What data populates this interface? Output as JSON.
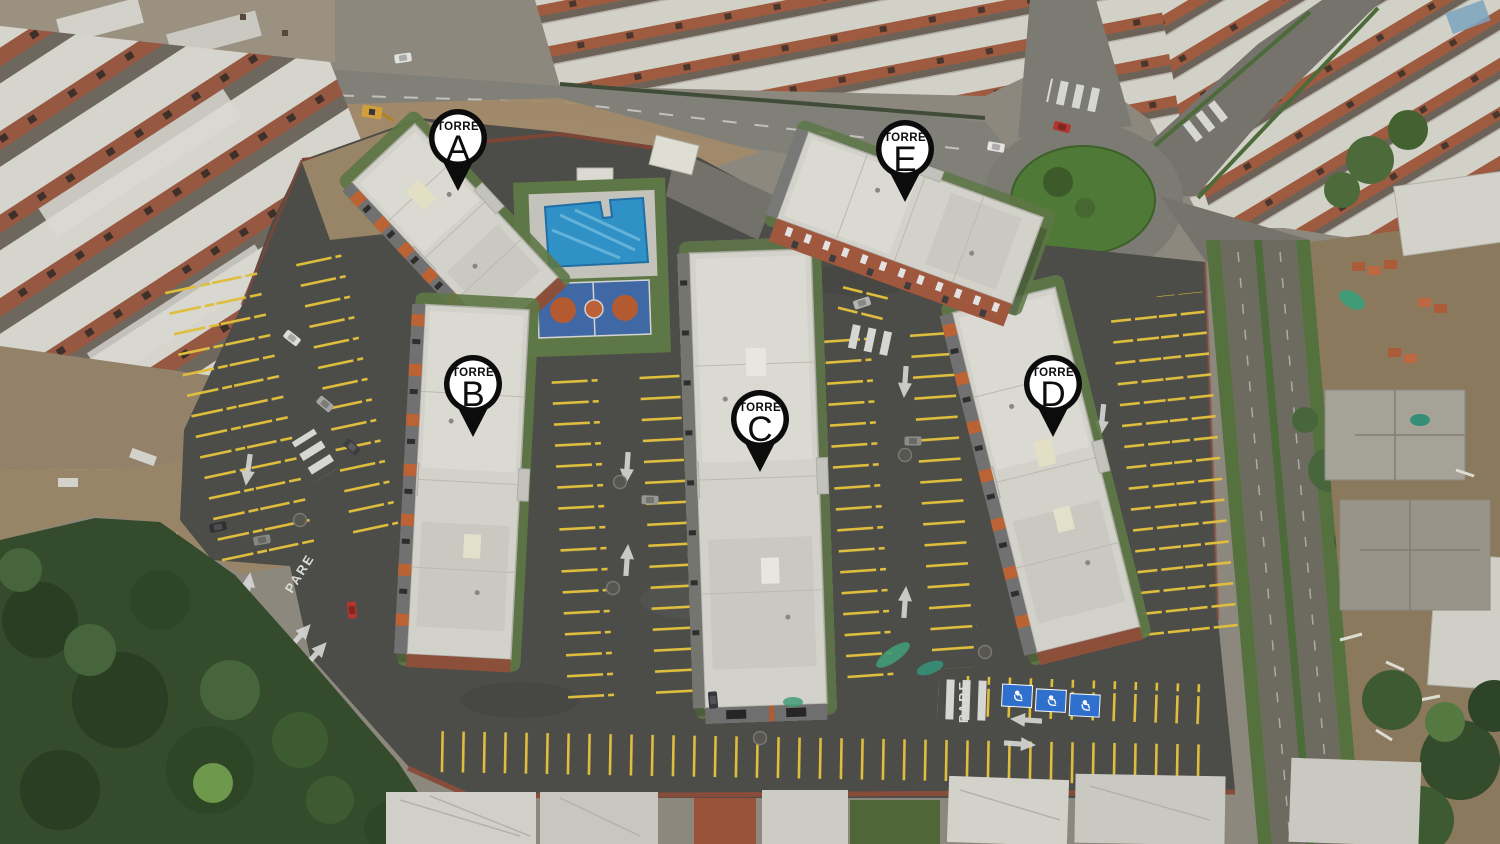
{
  "markers": [
    {
      "name": "torre-a",
      "prefix": "TORRE",
      "letter": "A",
      "x": 458,
      "y": 138
    },
    {
      "name": "torre-b",
      "prefix": "TORRE",
      "letter": "B",
      "x": 473,
      "y": 384
    },
    {
      "name": "torre-c",
      "prefix": "TORRE",
      "letter": "C",
      "x": 760,
      "y": 419
    },
    {
      "name": "torre-d",
      "prefix": "TORRE",
      "letter": "D",
      "x": 1053,
      "y": 384
    },
    {
      "name": "torre-e",
      "prefix": "TORRE",
      "letter": "E",
      "x": 905,
      "y": 149
    }
  ],
  "road": {
    "pare": "PARE"
  },
  "colors": {
    "asphalt": "#4b4a47",
    "roof_white": "#d8d6d0",
    "brick": "#a05a3e",
    "stall_yellow": "#e6c23c",
    "pool_blue": "#2e93cc",
    "grass": "#5e7845",
    "forest": "#32492a",
    "dirt": "#9b8568",
    "roundabout_green": "#4f7a34",
    "handicap_blue": "#2d6fd4",
    "marker_black": "#0c0c0c",
    "marker_white": "#ffffff"
  }
}
